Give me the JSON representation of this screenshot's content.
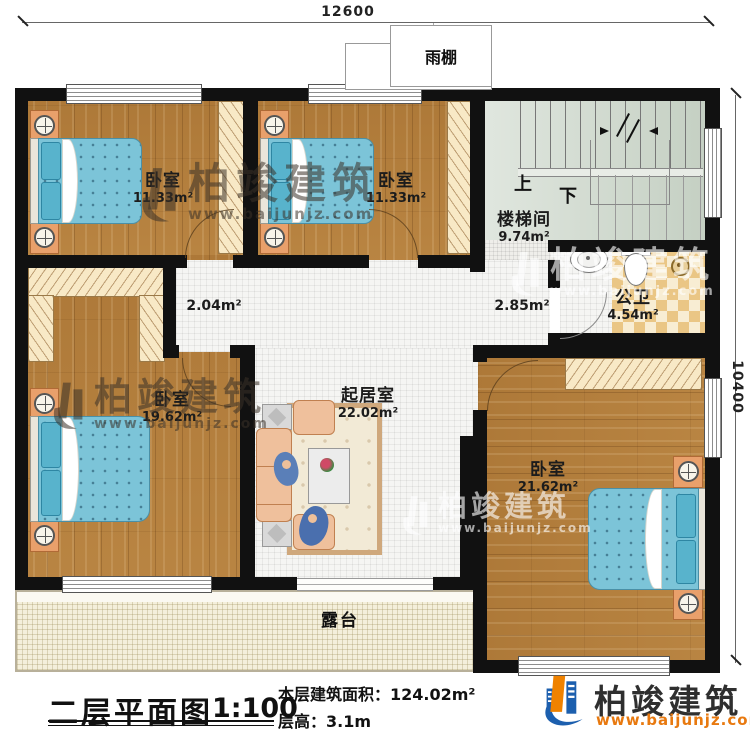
{
  "plan": {
    "title": "二层平面图",
    "scale": "1:100",
    "building_area": "本层建筑面积：124.02m²",
    "floor_height": "层高：3.1m"
  },
  "dimensions": {
    "top": "12600",
    "right": "10400"
  },
  "rooms": [
    {
      "id": "bedroom-1",
      "name": "卧室",
      "area": "11.33m²"
    },
    {
      "id": "bedroom-2",
      "name": "卧室",
      "area": "11.33m²"
    },
    {
      "id": "stairwell",
      "name": "楼梯间",
      "area": "9.74m²"
    },
    {
      "id": "bathroom",
      "name": "公卫",
      "area": "4.54m²"
    },
    {
      "id": "bedroom-3",
      "name": "卧室",
      "area": "19.62m²"
    },
    {
      "id": "living-room",
      "name": "起居室",
      "area": "22.02m²"
    },
    {
      "id": "bedroom-4",
      "name": "卧室",
      "area": "21.62m²"
    }
  ],
  "small_areas": [
    {
      "label": "2.04m²"
    },
    {
      "label": "2.85m²"
    }
  ],
  "annotations": {
    "canopy": "雨棚",
    "terrace": "露台",
    "stairs_up": "上",
    "stairs_down": "下"
  },
  "logo": {
    "company": "柏竣建筑",
    "website": "www.baijunjz.com"
  },
  "watermark": {
    "company": "柏竣建筑",
    "website": "www.baijunjz.com"
  },
  "colors": {
    "wall": "#111111",
    "wood_floor": "#b5813f",
    "tile": "#f5f5f3",
    "stair_floor": "#cfd9cd",
    "bath_checker": "#eac685",
    "terrace": "#f4efdb",
    "bed_blue": "#7cc4d8",
    "logo_blue": "#1c5fae",
    "logo_orange": "#ef8200"
  }
}
